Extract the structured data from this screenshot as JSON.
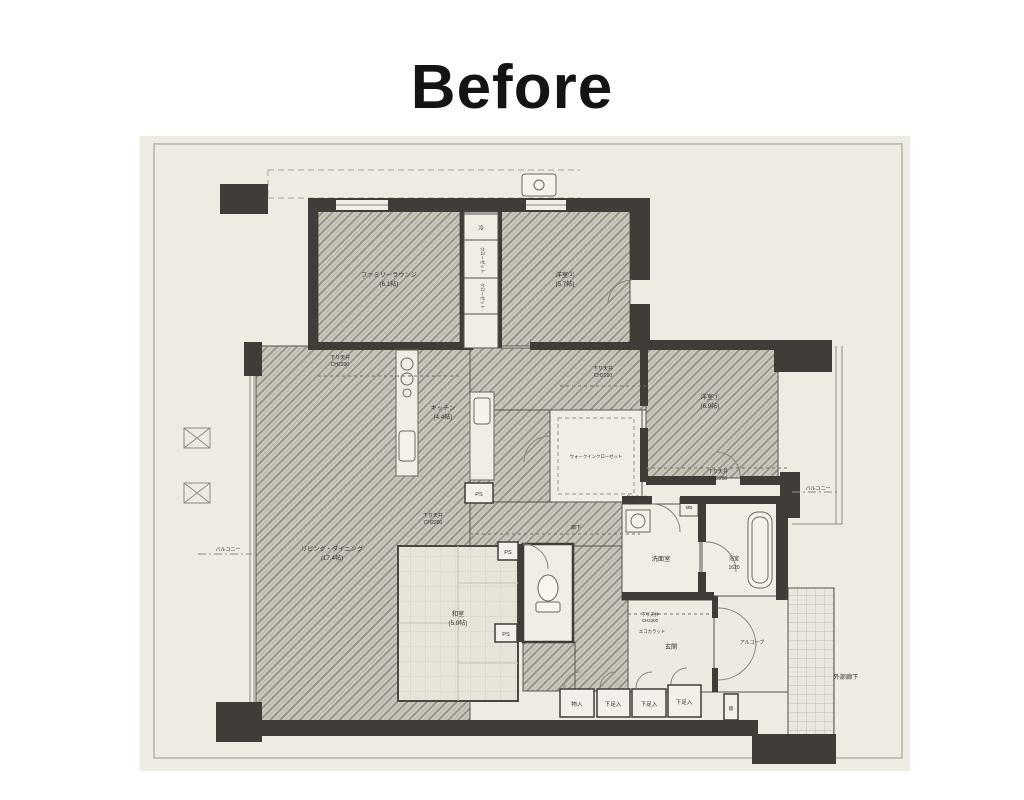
{
  "title": "Before",
  "rooms": {
    "family_lounge": {
      "name": "ファミリーラウンジ",
      "size": "(6.1帖)"
    },
    "bedroom_top": {
      "name": "洋室②",
      "size": "(5.7帖)"
    },
    "bedroom_right": {
      "name": "洋室①",
      "size": "(6.9帖)"
    },
    "living_dining": {
      "name": "リビング・ダイニング",
      "size": "(17.4帖)"
    },
    "kitchen": {
      "name": "キッチン",
      "size": "(4.4帖)"
    },
    "japanese_room": {
      "name": "和室",
      "size": "(5.9帖)"
    },
    "walk_in_closet": {
      "name": "ウォークインクローゼット"
    },
    "washroom": {
      "name": "洗面室"
    },
    "bathroom": {
      "name": "浴室",
      "size": "1620"
    },
    "entrance": {
      "name": "玄関"
    },
    "alcove": {
      "name": "アルコーブ"
    },
    "outside_corridor": {
      "name": "外部廊下"
    },
    "hallway": {
      "name": "廊下"
    },
    "balcony_left": "バルコニー",
    "balcony_right": "バルコニー"
  },
  "annotations": {
    "dropped_ceiling": {
      "line1": "下り天井",
      "line2": "CH2200"
    },
    "ecocarat": "エコカラット",
    "ps": "PS",
    "mb": "MB",
    "refrigerator": "冷",
    "closet": "クローゼット",
    "mirror": "鏡"
  },
  "storage": {
    "monoire": "物入",
    "shoe1": "下足入",
    "shoe2": "下足入",
    "shoe3": "下足入"
  },
  "colors": {
    "wall": "#403d38",
    "paper": "#edebe2",
    "hatch_base": "#ccc9bf"
  }
}
